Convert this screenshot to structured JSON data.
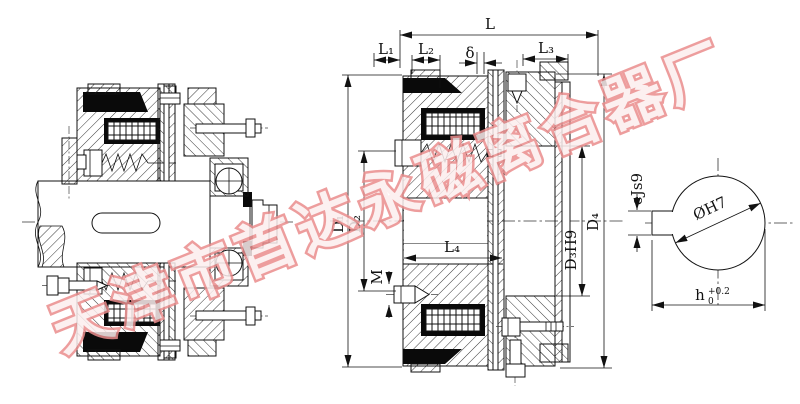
{
  "drawing": {
    "type": "electromagnetic-clutch-cross-section",
    "views": {
      "left": "assembled clutch section with shaft",
      "middle": "clutch section with dimension callouts",
      "right": "bore cross-section with keyway"
    }
  },
  "dimensions": {
    "L": "L",
    "L1": "L₁",
    "L2": "L₂",
    "delta": "δ",
    "L3": "L₃",
    "L4": "L₄",
    "M": "M",
    "D1": "D₁",
    "D2": "D₂",
    "D3": "D₃H9",
    "D4": "D₄",
    "e": "eJs9",
    "bore": "ØH7",
    "h": "h",
    "h_tol_upper": "+0.2",
    "h_tol_lower": "0"
  },
  "watermark": {
    "text": "天津市首达永磁离合器厂",
    "color": "#ea8d8d"
  }
}
